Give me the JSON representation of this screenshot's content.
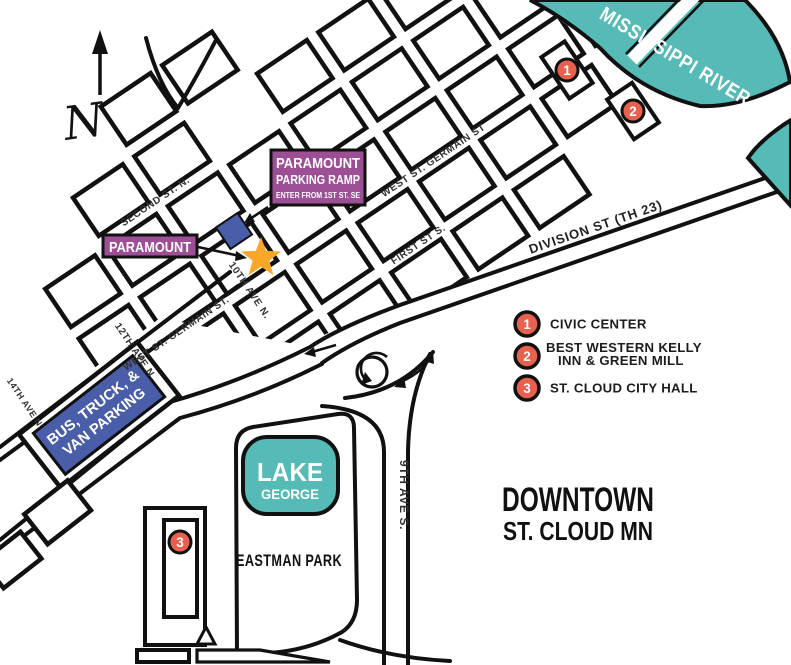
{
  "map": {
    "title_line1": "DOWNTOWN",
    "title_line2": "ST. CLOUD MN",
    "compass_n": "N",
    "river_label": "MISSISSIPPI RIVER",
    "lake_line1": "LAKE",
    "lake_line2": "GEORGE",
    "park_label": "EASTMAN PARK",
    "streets": {
      "second": "SECOND ST. N.",
      "germain_upper": "WEST ST. GERMAIN ST",
      "germain_lower": "WEST ST. GERMAIN ST.",
      "first": "FIRST ST S.",
      "division": "DIVISION ST (TH 23)",
      "ave10": "10TH AVE N.",
      "ave12": "12TH AVE N.",
      "ave14": "14TH AVE N.",
      "ave9": "9TH AVE S."
    },
    "paramount_label": "PARAMOUNT",
    "ramp_box": {
      "line1": "PARAMOUNT",
      "line2": "PARKING RAMP",
      "line3": "ENTER FROM 1ST ST. SE"
    },
    "bus_parking": {
      "line1": "BUS, TRUCK, &",
      "line2": "VAN PARKING"
    },
    "markers": {
      "m1": "1",
      "m2": "2",
      "m3": "3"
    },
    "legend": {
      "item1_num": "1",
      "item1_label": "CIVIC CENTER",
      "item2_num": "2",
      "item2_label_line1": "BEST WESTERN KELLY",
      "item2_label_line2": "INN & GREEN MILL",
      "item3_num": "3",
      "item3_label": "ST. CLOUD CITY HALL"
    },
    "colors": {
      "teal": "#56BAB6",
      "purple": "#9D4F96",
      "blue": "#4A5DA8",
      "marker_red": "#E8614E",
      "star_orange": "#F9A72B",
      "ink": "#111111"
    }
  }
}
